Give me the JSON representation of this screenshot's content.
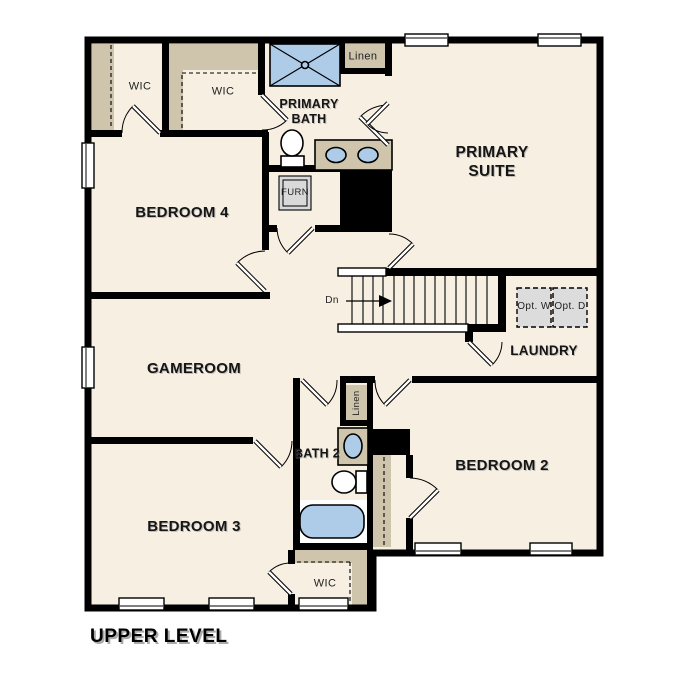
{
  "title": "UPPER LEVEL",
  "labels": {
    "primary_suite": "PRIMARY SUITE",
    "primary_bath": "PRIMARY BATH",
    "bedroom_2": "BEDROOM 2",
    "bedroom_3": "BEDROOM 3",
    "bedroom_4": "BEDROOM 4",
    "gameroom": "GAMEROOM",
    "laundry": "LAUNDRY",
    "bath_2": "BATH 2",
    "wic_1": "WIC",
    "wic_2": "WIC",
    "wic_3": "WIC",
    "linen_1": "Linen",
    "linen_2": "Linen",
    "furnace": "FURN",
    "opt_washer": "Opt. W",
    "opt_dryer": "Opt. D",
    "stairs_down": "Dn"
  },
  "colors": {
    "wall": "#000000",
    "floor": "#f6efe2",
    "closet": "#cfc5ac",
    "blue": "#aecbe8",
    "opt": "#dcdcdc",
    "furn": "#d9d9d9",
    "background": "#ffffff"
  }
}
